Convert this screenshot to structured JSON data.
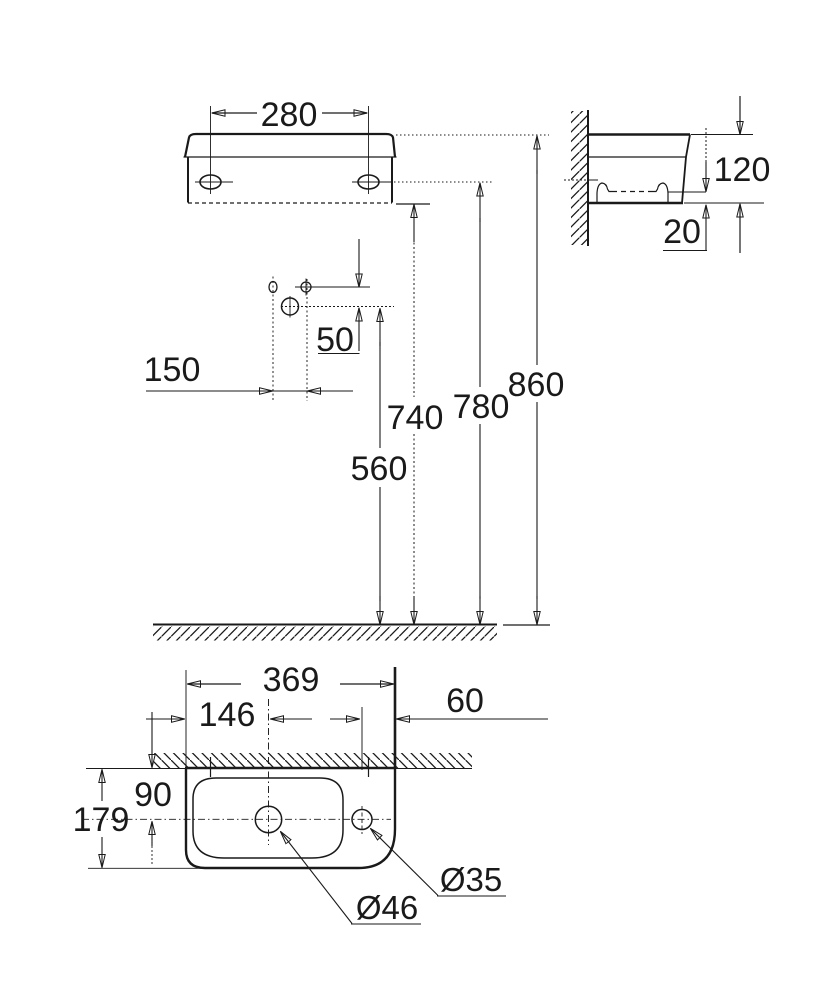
{
  "drawing_title": "washbasin-installation-dimension-drawing",
  "colors": {
    "line": "#1a1a1a",
    "thin": "#3c3c3c",
    "muted_gray": "#8c8c8c",
    "background": "#ffffff"
  },
  "dims": {
    "mounting_hole_spacing": "280",
    "basin_height": "120",
    "bottom_recess": "20",
    "faucet_hole_offset": "50",
    "supply_centers": "150",
    "height_drain": "560",
    "height_basin_bottom": "740",
    "height_mounting_holes": "780",
    "height_rim": "860",
    "basin_width": "369",
    "drain_center_from_left": "146",
    "tap_hole_from_right": "60",
    "drain_center_from_wall": "90",
    "basin_depth": "179",
    "drain_hole_diameter": "Ø46",
    "tap_hole_diameter": "Ø35"
  }
}
